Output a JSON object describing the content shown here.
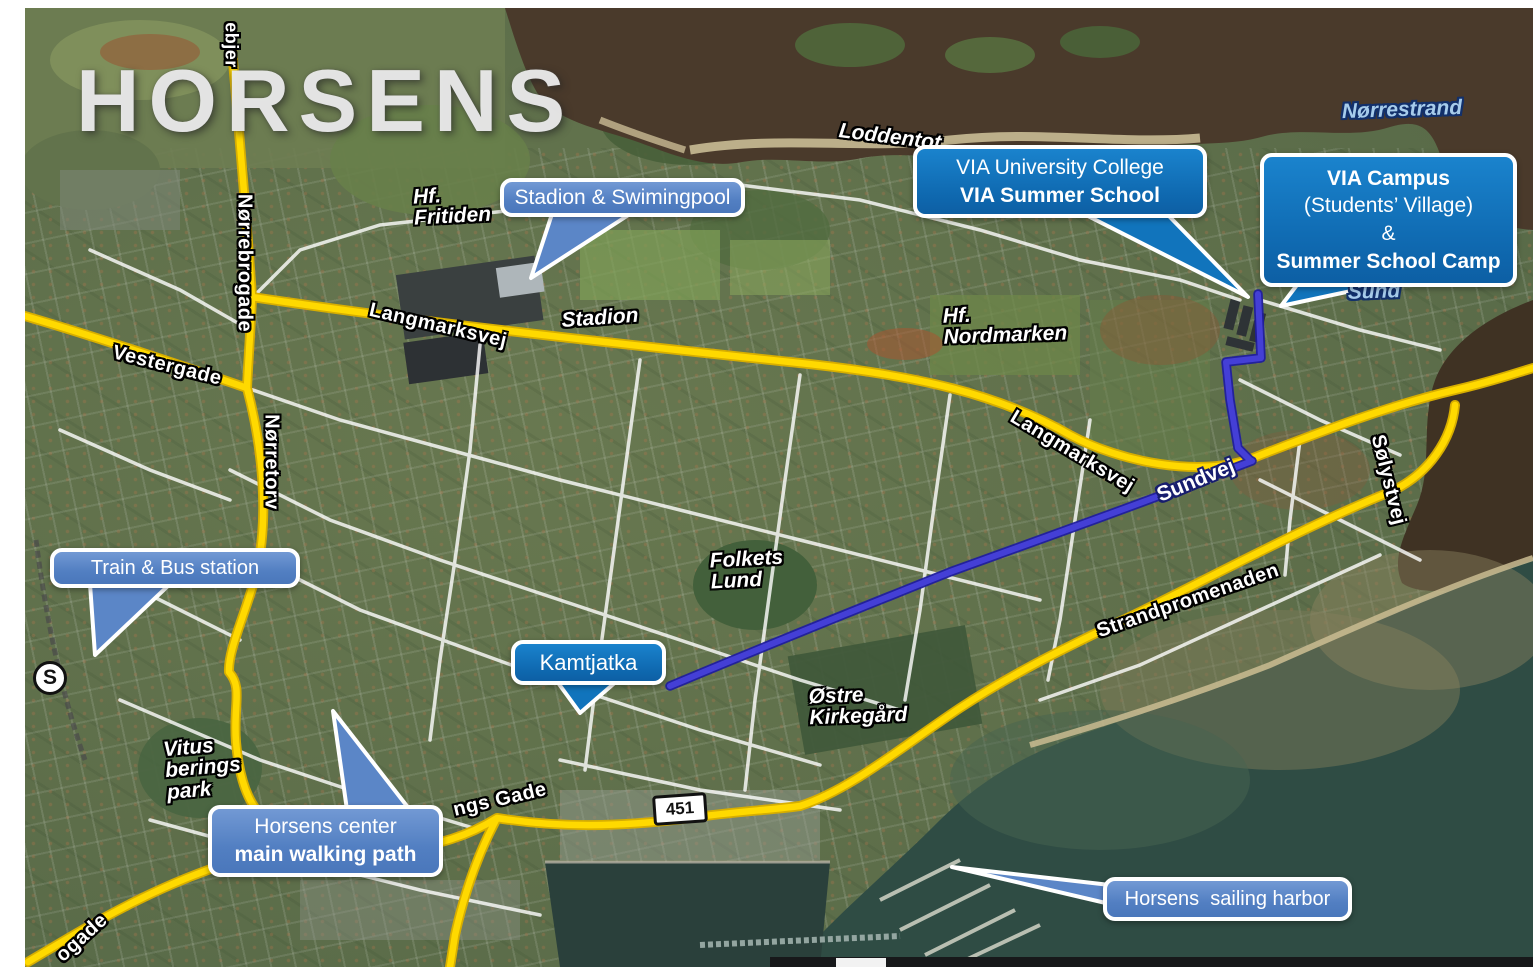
{
  "title": "HORSENS",
  "callouts": {
    "stadion_pool": {
      "text": "Stadion & Swimingpool"
    },
    "via_university": {
      "line1": "VIA University College",
      "line2": "VIA Summer School"
    },
    "via_campus": {
      "line1": "VIA Campus",
      "line2": "(Students’ Village)",
      "line3": "&",
      "line4": "Summer School Camp"
    },
    "train_bus": {
      "text": "Train & Bus station"
    },
    "kamtjatka": {
      "text": "Kamtjatka"
    },
    "horsens_center": {
      "line1": "Horsens center",
      "line2": "main walking path"
    },
    "sailing_harbor": {
      "text": "Horsens  sailing harbor"
    }
  },
  "street_labels": {
    "vestergade": "Vestergade",
    "norrebrogade": "Nørrebrogade",
    "norretorv": "Nørretorv",
    "langmarksvej_west": "Langmarksvej",
    "langmarksvej_east": "Langmarksvej",
    "sundvej": "Sundvej",
    "solystvej": "Sølystvej",
    "strandpromenaden": "Strandpromenaden",
    "gs_gade_partial": "ngs Gade",
    "ogade_partial": "ogade",
    "ebjer_partial": "ebjer"
  },
  "place_labels": {
    "hf_fritiden": [
      "Hf.",
      "Fritiden"
    ],
    "stadion": [
      "Stadion"
    ],
    "hf_nordmarken": [
      "Hf.",
      "Nordmarken"
    ],
    "folkets_lund": [
      "Folkets",
      "Lund"
    ],
    "ostre_kirkegard": [
      "Østre",
      "Kirkegård"
    ],
    "vitus_berings_park": [
      "Vitus",
      "berings",
      "park"
    ],
    "loddentot": [
      "Loddentot"
    ]
  },
  "water_labels": {
    "norrestrand": "Nørrestrand",
    "sund_partial": "Sund"
  },
  "badges": {
    "road_number": "451",
    "station": "S"
  },
  "colors": {
    "route_blue": "#443fd6",
    "main_road_yellow": "#ffd900",
    "callout_dark_blue": "#1173bd",
    "callout_light_blue": "#5b87c9",
    "water_north": "#4a3a2b",
    "water_sea": "#2f4c44"
  }
}
